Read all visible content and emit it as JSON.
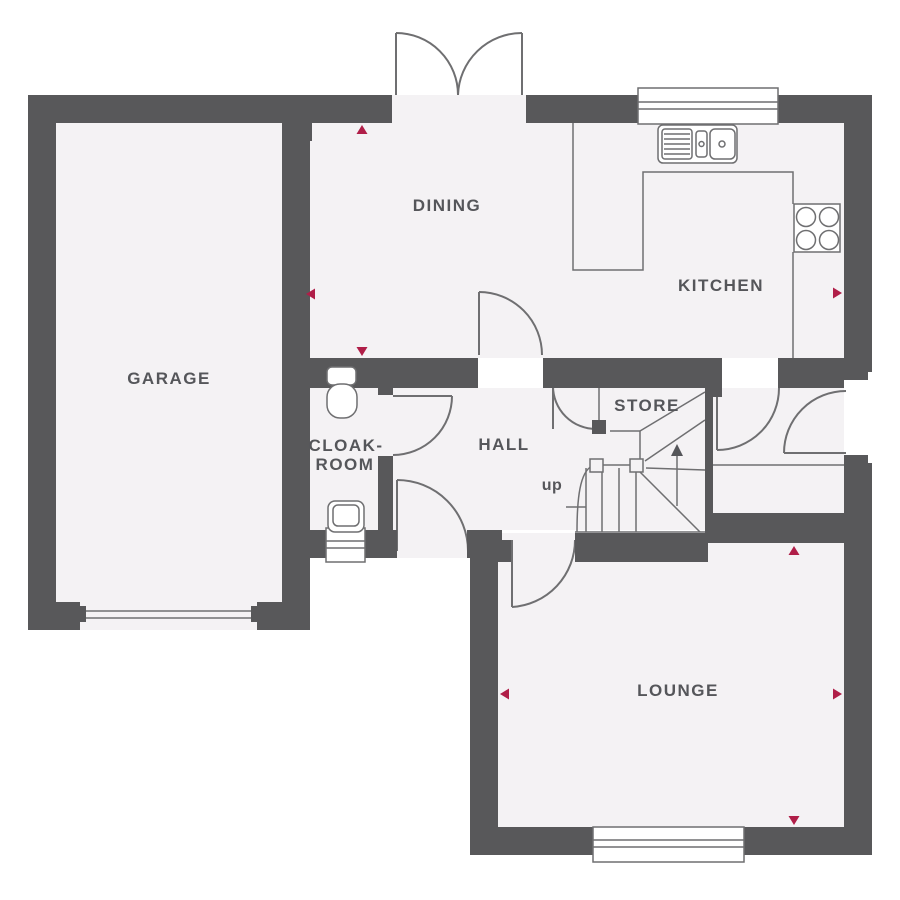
{
  "plan": {
    "type": "residential-ground-floor-plan",
    "colors": {
      "wall": "#58585a",
      "floor": "#f4f2f4",
      "line": "#6f6f71",
      "label": "#55565a",
      "accent": "#b01e48",
      "bg": "#ffffff"
    },
    "rooms": {
      "garage": {
        "label": "GARAGE"
      },
      "dining": {
        "label": "DINING"
      },
      "kitchen": {
        "label": "KITCHEN"
      },
      "cloakroom": {
        "line1": "CLOAK-",
        "line2": "ROOM"
      },
      "hall": {
        "label": "HALL"
      },
      "store": {
        "label": "STORE"
      },
      "lounge": {
        "label": "LOUNGE"
      }
    },
    "stairs": {
      "direction_label": "up"
    },
    "icons": [
      "french-doors-icon",
      "kitchen-sink-icon",
      "hob-icon",
      "window-icon",
      "wc-icon",
      "wash-basin-icon",
      "staircase-icon",
      "garage-door-icon",
      "door-swing-icon",
      "measure-arrow-icon"
    ],
    "measure_arrow_count": 8
  }
}
